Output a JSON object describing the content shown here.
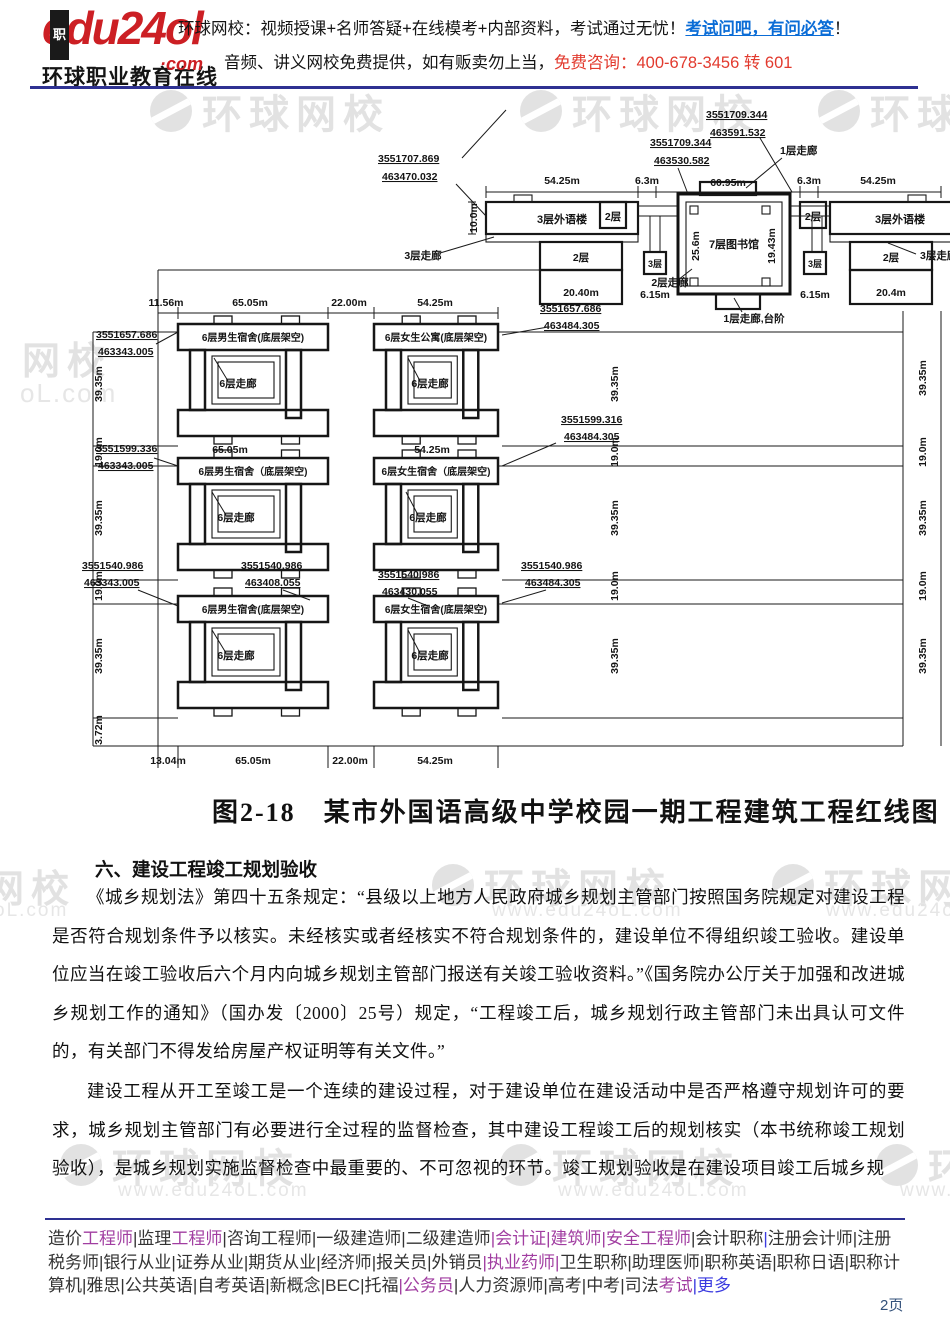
{
  "header": {
    "logo_text": "edu24o",
    "logo_l": "l",
    "logo_com": "·com",
    "logo_badge": "职",
    "logo_subtitle": "环球职业教育在线",
    "line1_prefix": "环球网校：视频授课+名师答疑+在线模考+内部资料，考试通过无忧！",
    "line1_link": "考试问吧，有问必答",
    "line1_suffix": "！",
    "line2_prefix": "音频、讲义网校免费提供，如有贩卖勿上当，",
    "line2_phone": "免费咨询：400-678-3456 转 601"
  },
  "watermark": {
    "brand": "环球网校",
    "site": "www.edu24oL.com",
    "partial_a": "网校",
    "partial_b": "oL.com"
  },
  "figure": {
    "top": {
      "coord_nw": [
        "3551707.869",
        "463470.032"
      ],
      "coord_n1": [
        "3551709.344",
        "463530.582"
      ],
      "coord_n2": [
        "3551709.344",
        "463591.532"
      ],
      "dims": [
        "54.25m",
        "6.3m",
        "60.95m",
        "6.3m",
        "54.25m"
      ],
      "corridor_1f": "1层走廊",
      "left": {
        "main": "3层外语楼",
        "corridor": "3层走廊",
        "f2a": "2层",
        "f2b": "2层",
        "f3": "3层",
        "width": "20.40m",
        "gap": "6.15m",
        "height": "10.0m"
      },
      "lib": {
        "name": "7层图书馆",
        "width": "25.6m",
        "height": "19.43m",
        "corr2": "2层走廊",
        "corr1": "1层走廊,台阶"
      },
      "right": {
        "f2a": "2层",
        "main": "3层外语楼",
        "f2b": "2层",
        "f3": "3层",
        "gap": "6.15m",
        "width": "20.4m",
        "corridor": "3层走廊"
      }
    },
    "dorm": {
      "top_dims": [
        "11.56m",
        "65.05m",
        "22.00m",
        "54.25m"
      ],
      "mid_dims": [
        "65.05m",
        "54.25m"
      ],
      "bottom_dims": [
        "13.04m",
        "65.05m",
        "22.00m",
        "54.25m"
      ],
      "v_dims": [
        "39.35m",
        "19.0m",
        "39.35m",
        "19.0m",
        "39.35m"
      ],
      "v_dim_bottom": "3.72m",
      "rows": [
        {
          "l": "6层男生宿舍(底层架空)",
          "lc": "6层走廊",
          "r": "6层女生公寓(底层架空)",
          "rc": "6层走廊"
        },
        {
          "l": "6层男生宿舍（底层架空)",
          "lc": "6层走廊",
          "r": "6层女生宿舍（底层架空)",
          "rc": "6层走廊"
        },
        {
          "l": "6层男生宿舍(底层架空)",
          "lc": "6层走廊",
          "r": "6层女生宿舍(底层架空)",
          "rc": "6层走廊"
        }
      ],
      "coords": {
        "r1_left": [
          "3551657.686",
          "463343.005"
        ],
        "r1_right": [
          "3551657.686",
          "463484.305"
        ],
        "r2_left": [
          "3551599.336",
          "463343.005"
        ],
        "r2_right": [
          "3551599.316",
          "463484.305"
        ],
        "r3_left": [
          "3551540.986",
          "463343.005"
        ],
        "r3_mid_l": [
          "3551540.986",
          "463408.055"
        ],
        "r3_mid_r": [
          "3551540.986",
          "463430.055"
        ],
        "r3_right": [
          "3551540.986",
          "463484.305"
        ]
      }
    }
  },
  "caption": "图2-18　某市外国语高级中学校园一期工程建筑工程红线图",
  "section": {
    "heading": "六、建设工程竣工规划验收",
    "p1": "《城乡规划法》第四十五条规定：“县级以上地方人民政府城乡规划主管部门按照国务院规定对建设工程是否符合规划条件予以核实。未经核实或者经核实不符合规划条件的，建设单位不得组织竣工验收。建设单位应当在竣工验收后六个月内向城乡规划主管部门报送有关竣工验收资料。”《国务院办公厅关于加强和改进城乡规划工作的通知》（国办发〔2000〕25号）规定，“工程竣工后，城乡规划行政主管部门未出具认可文件的，有关部门不得发给房屋产权证明等有关文件。”",
    "p2": "建设工程从开工至竣工是一个连续的建设过程，对于建设单位在建设活动中是否严格遵守规划许可的要求，城乡规划主管部门有必要进行全过程的监督检查，其中建设工程竣工后的规划核实（本书统称竣工规划验收），是城乡规划实施监督检查中最重要的、不可忽视的环节。竣工规划验收是在建设项目竣工后城乡规"
  },
  "footer": {
    "items": [
      {
        "t": "造价",
        "c": "k"
      },
      {
        "t": "工程师",
        "c": "p"
      },
      {
        "t": "|",
        "c": "k"
      },
      {
        "t": "监理",
        "c": "k"
      },
      {
        "t": "工程师",
        "c": "p"
      },
      {
        "t": "|",
        "c": "k"
      },
      {
        "t": "咨询工程师",
        "c": "k"
      },
      {
        "t": "|",
        "c": "k"
      },
      {
        "t": "一级建造师",
        "c": "k"
      },
      {
        "t": "|",
        "c": "k"
      },
      {
        "t": "二级建造师",
        "c": "k"
      },
      {
        "t": "|",
        "c": "p"
      },
      {
        "t": "会计证",
        "c": "p"
      },
      {
        "t": "|",
        "c": "p"
      },
      {
        "t": "建筑师",
        "c": "p"
      },
      {
        "t": "|",
        "c": "p"
      },
      {
        "t": "安全工程师",
        "c": "p"
      },
      {
        "t": "|",
        "c": "k"
      },
      {
        "t": "会计职称",
        "c": "k"
      },
      {
        "t": "|",
        "c": "b"
      },
      {
        "t": "注册会计师",
        "c": "k"
      },
      {
        "t": "|",
        "c": "k"
      },
      {
        "t": "注册税务师",
        "c": "k"
      },
      {
        "t": "|",
        "c": "k"
      },
      {
        "t": "银行从业",
        "c": "k"
      },
      {
        "t": "|",
        "c": "k"
      },
      {
        "t": "证券从业",
        "c": "k"
      },
      {
        "t": "|",
        "c": "k"
      },
      {
        "t": "期货从业",
        "c": "k"
      },
      {
        "t": "|",
        "c": "k"
      },
      {
        "t": "经济师",
        "c": "k"
      },
      {
        "t": "|",
        "c": "k"
      },
      {
        "t": "报关员",
        "c": "k"
      },
      {
        "t": "|",
        "c": "k"
      },
      {
        "t": "外销员",
        "c": "k"
      },
      {
        "t": "|",
        "c": "p"
      },
      {
        "t": "执业药师",
        "c": "p"
      },
      {
        "t": "|",
        "c": "p"
      },
      {
        "t": "卫生职称",
        "c": "k"
      },
      {
        "t": "|",
        "c": "k"
      },
      {
        "t": "助理医师",
        "c": "k"
      },
      {
        "t": "|",
        "c": "k"
      },
      {
        "t": "职称英语",
        "c": "k"
      },
      {
        "t": "|",
        "c": "k"
      },
      {
        "t": "职称日语",
        "c": "k"
      },
      {
        "t": "|",
        "c": "k"
      },
      {
        "t": "职称计算机",
        "c": "k"
      },
      {
        "t": "|",
        "c": "k"
      },
      {
        "t": "雅思",
        "c": "k"
      },
      {
        "t": "|",
        "c": "k"
      },
      {
        "t": "公共英语",
        "c": "k"
      },
      {
        "t": "|",
        "c": "k"
      },
      {
        "t": "自考英语",
        "c": "k"
      },
      {
        "t": "|",
        "c": "k"
      },
      {
        "t": "新概念",
        "c": "k"
      },
      {
        "t": "|",
        "c": "k"
      },
      {
        "t": "BEC",
        "c": "k"
      },
      {
        "t": "|",
        "c": "k"
      },
      {
        "t": "托福",
        "c": "k"
      },
      {
        "t": "|",
        "c": "p"
      },
      {
        "t": "公务员",
        "c": "p"
      },
      {
        "t": "|",
        "c": "k"
      },
      {
        "t": "人力资源师",
        "c": "k"
      },
      {
        "t": "|",
        "c": "k"
      },
      {
        "t": "高考",
        "c": "k"
      },
      {
        "t": "|",
        "c": "k"
      },
      {
        "t": "中考",
        "c": "k"
      },
      {
        "t": "|",
        "c": "k"
      },
      {
        "t": "司法",
        "c": "k"
      },
      {
        "t": "考试",
        "c": "p"
      },
      {
        "t": "|",
        "c": "b"
      },
      {
        "t": "更多",
        "c": "b"
      }
    ],
    "page_number": "2页"
  }
}
